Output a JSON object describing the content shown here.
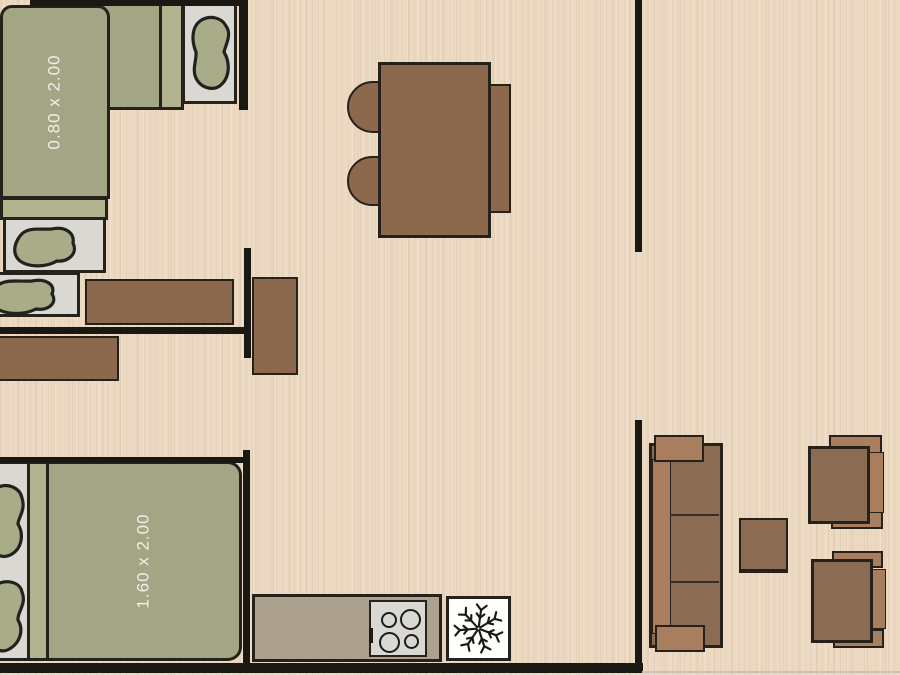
{
  "plan": {
    "bedroom_top": {
      "bed_label": "0.80 x 2.00"
    },
    "bedroom_bottom": {
      "bed_label": "1.60 x 2.00"
    }
  },
  "icons": {
    "freezer": "snowflake-icon",
    "pillows": "pillow-icon",
    "burners": "burner-ring-icon"
  },
  "colors": {
    "floor": "#ecd9c2",
    "wall": "#191813",
    "outline": "#26211a",
    "bed_green": "#a2a684",
    "bed_fold": "#b0b38e",
    "mattress_gray": "#d9d8d2",
    "pillow_green": "#a8ac88",
    "furniture_brown": "#8c684c",
    "sofa_seat": "#8b6b52",
    "sofa_trim": "#a87e5e",
    "counter": "#aca08e",
    "stove": "#d9d8d3",
    "fridge": "#fefefc",
    "label_text": "#f2efe6"
  }
}
